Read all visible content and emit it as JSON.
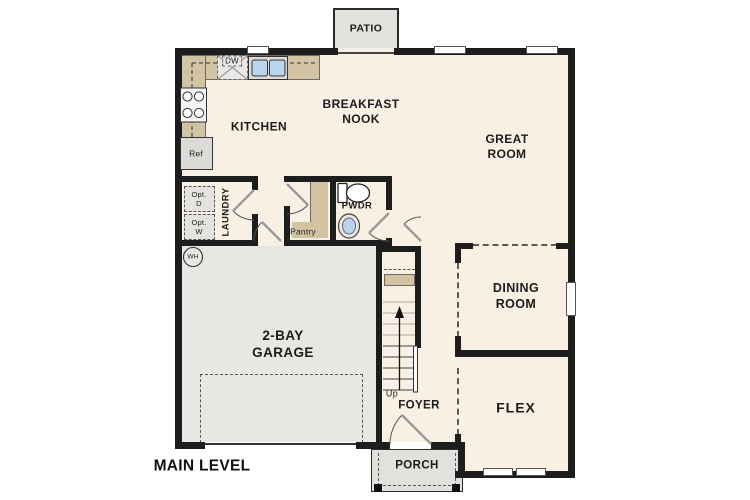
{
  "title": "MAIN LEVEL",
  "rooms": {
    "patio": "PATIO",
    "kitchen": "KITCHEN",
    "breakfast_nook": [
      "BREAKFAST",
      "NOOK"
    ],
    "great_room": [
      "GREAT",
      "ROOM"
    ],
    "laundry": "LAUNDRY",
    "pantry": "Pantry",
    "powder": "PWDR",
    "garage": [
      "2-BAY",
      "GARAGE"
    ],
    "foyer": "FOYER",
    "dining_room": [
      "DINING",
      "ROOM"
    ],
    "flex": "FLEX",
    "porch": "PORCH"
  },
  "fixtures": {
    "dishwasher": "DW",
    "refrigerator": "Ref",
    "water_heater": "WH",
    "optional_dryer": [
      "Opt.",
      "D"
    ],
    "optional_washer": [
      "Opt.",
      "W"
    ],
    "stairs_direction": "Up"
  },
  "colors": {
    "floor": "#f8f0e2",
    "garage_floor": "#e8e7e4",
    "hardscape": "#e2e1dd",
    "counter": "#d2c3a3",
    "wall": "#1d1d1d",
    "fixture_water": "#b9d4ee"
  }
}
